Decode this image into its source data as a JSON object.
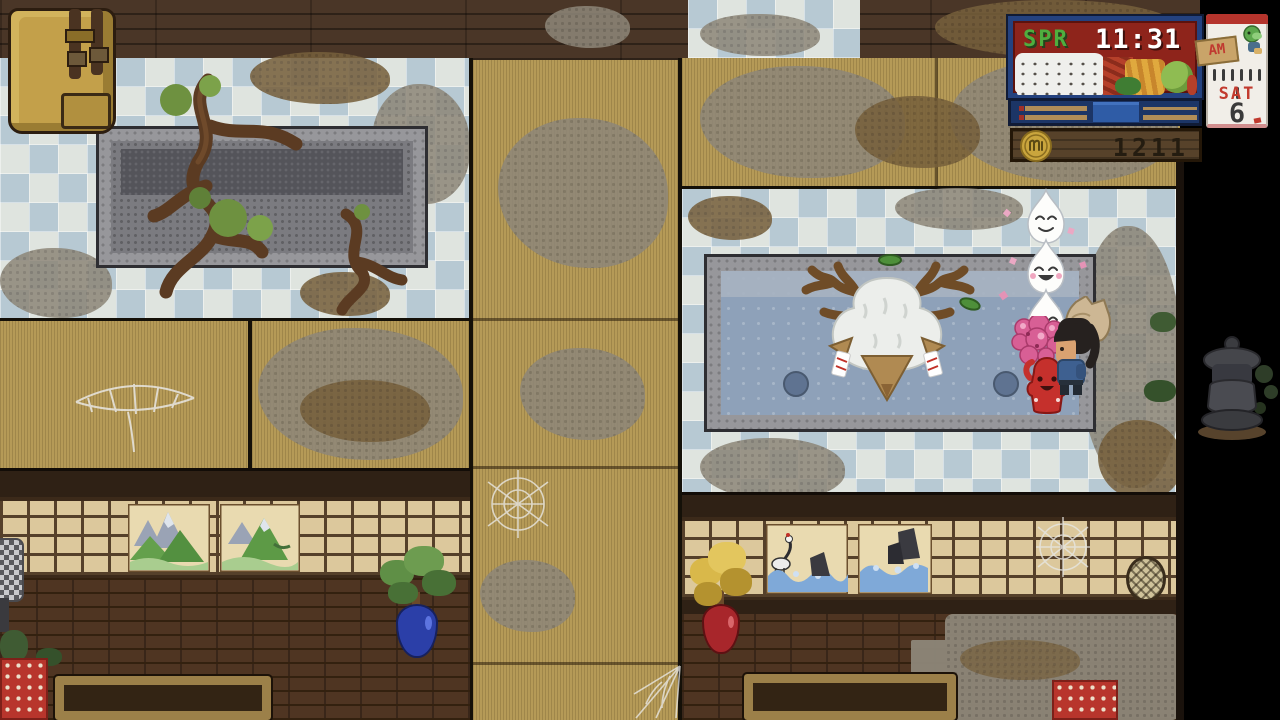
{
  "hud": {
    "season_label": "SPR",
    "clock_time": "11:31",
    "meridiem": "AM",
    "calendar": {
      "weekday": "SAT",
      "day": "6"
    },
    "money": "1211",
    "icons": {
      "rice": "rice-bowl-icon",
      "vegetables": "vegetables-icon",
      "coin": "coin-icon",
      "turtle": "turtle-mascot-icon",
      "am_tag": "am-tag-icon"
    },
    "colors": {
      "panel_navy": "#24427f",
      "screen_red": "#8e241b",
      "season_green": "#4fae3f",
      "calendar_red": "#c23a2e",
      "coin_gold": "#c9a53d",
      "meter_blue": "#2f5ca6"
    }
  },
  "scene": {
    "location": "bathhouse-interior",
    "entities": [
      "backpack",
      "empty-stone-bath",
      "overgrown-roots",
      "occupied-bath",
      "deer-spirit",
      "tea-spirit-stack",
      "blossom-spirit",
      "red-spirit",
      "player-character",
      "stone-lantern",
      "potted-tree-blue",
      "potted-tree-red",
      "standing-lamp",
      "mountain-painting",
      "wave-painting",
      "spider-web",
      "floor-cushion",
      "low-table"
    ],
    "water_color": "#8ea1b9",
    "tile_colors": [
      "#dfe4df",
      "#b7c9d3"
    ],
    "tatami_color": "#b59a57"
  }
}
